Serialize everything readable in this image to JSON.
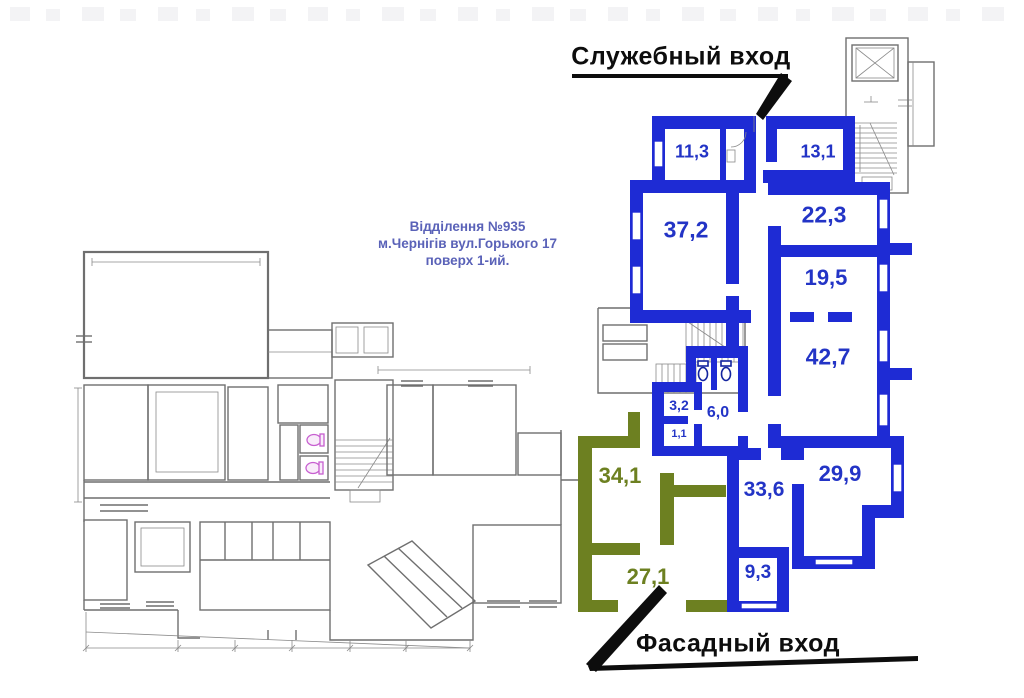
{
  "floor_plan": {
    "info_block": {
      "line1": "Відділення №935",
      "line2": "м.Чернігів вул.Горького 17",
      "line3": "поверх 1-ий."
    },
    "entrances": {
      "service": "Служебный вход",
      "facade": "Фасадный вход"
    },
    "highlighted_rooms": {
      "blue": [
        {
          "area": "11,3"
        },
        {
          "area": "13,1"
        },
        {
          "area": "37,2"
        },
        {
          "area": "22,3"
        },
        {
          "area": "19,5"
        },
        {
          "area": "42,7"
        },
        {
          "area": "3,2"
        },
        {
          "area": "6,0"
        },
        {
          "area": "1,1"
        },
        {
          "area": "33,6"
        },
        {
          "area": "29,9"
        },
        {
          "area": "9,3"
        }
      ],
      "green": [
        {
          "area": "34,1"
        },
        {
          "area": "27,1"
        }
      ]
    },
    "colors": {
      "blue_wall": "#1e2bd4",
      "green_wall": "#6d8021",
      "blue_label": "#2334c6",
      "green_label": "#6d8021",
      "info_text": "#5a62b8",
      "plan_line": "#6f6f6f",
      "toilet_magenta": "#c75fd0",
      "annotation": "#0d0d0d"
    }
  }
}
